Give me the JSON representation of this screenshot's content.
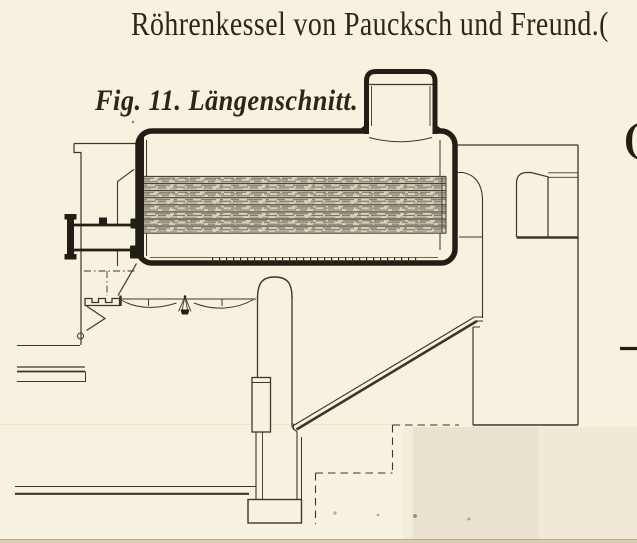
{
  "document": {
    "title": "Röhrenkessel von Paucksch und Freund.",
    "title_trailing_glyph": "(",
    "figure_label": "Fig. 11. Längenschnitt.",
    "figure_number": "11",
    "view_type": "Längenschnitt",
    "subject": "Röhrenkessel",
    "makers": "Paucksch und Freund"
  },
  "artifacts": {
    "cut_off_glyph": "(",
    "edge_tick_present": "yes"
  },
  "colors": {
    "paper": "#f7f2e0",
    "paper-patch": "#e9e2cf",
    "paper-patch-light": "#efe9d6",
    "ink": "#221e15",
    "line": "#3a362b",
    "hatch-base": "#d8d1ba"
  }
}
